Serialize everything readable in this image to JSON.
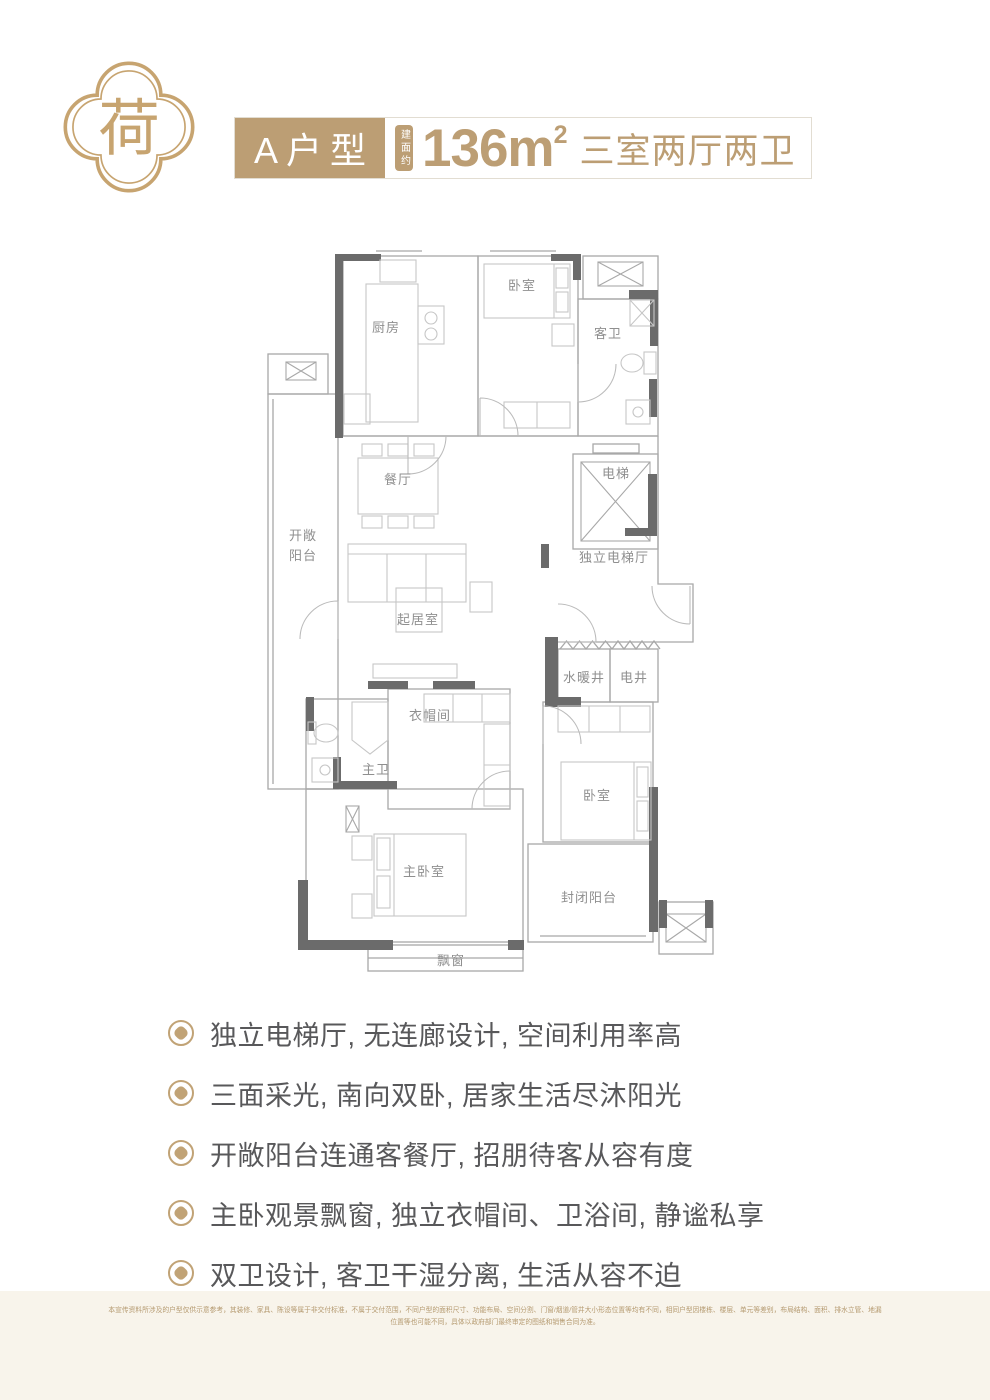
{
  "colors": {
    "accent_gold": "#bc9e74",
    "logo_gold": "#c7a470",
    "bullet_gold": "#c1a376",
    "feature_text": "#58585a",
    "plan_wall_dark": "#6b6b6b",
    "plan_line": "#a8a8a8",
    "plan_label": "#8f8f8f",
    "disclaimer_bg": "#f8f4eb",
    "disclaimer_text": "#b59a70"
  },
  "logo": {
    "character": "荷"
  },
  "header": {
    "type_label": "A户型",
    "area_prefix": "建面约",
    "area_value": "136m",
    "area_sup": "2",
    "rooms_text": "三室两厅两卫"
  },
  "floorplan": {
    "labels": {
      "kitchen": "厨房",
      "bedroom_top": "卧室",
      "guest_bath": "客卫",
      "dining": "餐厅",
      "elevator": "电梯",
      "open_balcony_1": "开敞",
      "open_balcony_2": "阳台",
      "living": "起居室",
      "elevator_hall": "独立电梯厅",
      "water_shaft": "水暖井",
      "electric_shaft": "电井",
      "cloakroom": "衣帽间",
      "master_bath": "主卫",
      "bedroom_south": "卧室",
      "master_bedroom": "主卧室",
      "enclosed_balcony": "封闭阳台",
      "bay_window": "飘窗"
    }
  },
  "features": {
    "items": [
      "独立电梯厅, 无连廊设计, 空间利用率高",
      "三面采光, 南向双卧, 居家生活尽沐阳光",
      "开敞阳台连通客餐厅, 招朋待客从容有度",
      "主卧观景飘窗, 独立衣帽间、卫浴间, 静谧私享",
      "双卫设计, 客卫干湿分离, 生活从容不迫"
    ]
  },
  "disclaimer": {
    "line1": "本宣传资料所涉及的户型仅供示意参考，其装修、家具、陈设等属于非交付标准，不属于交付范围，不同户型的面积尺寸、功能布局、空间分割、门窗/烟道/管井大小形态位置等均有不同，相同户型因楼栋、楼层、单元等差别，布局结构、面积、排水立管、地漏",
    "line2": "位置等也可能不同，具体以政府部门最终审定的图纸和销售合同为准。"
  }
}
